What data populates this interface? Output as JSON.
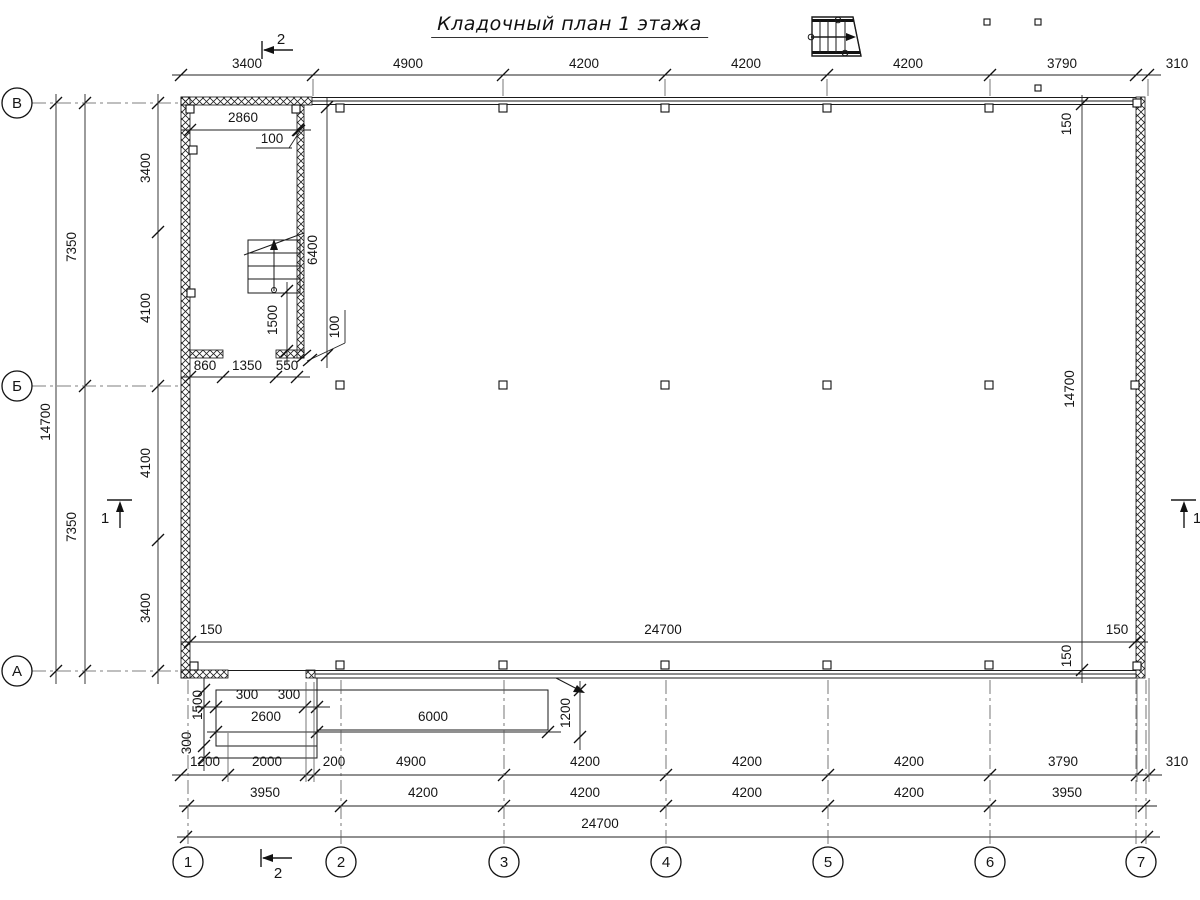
{
  "title": "Кладочный план 1 этажа",
  "axes": {
    "rows": [
      {
        "label": "В",
        "cy": 103
      },
      {
        "label": "Б",
        "cy": 386
      },
      {
        "label": "А",
        "cy": 671
      }
    ],
    "cols": [
      {
        "label": "1",
        "cx": 188
      },
      {
        "label": "2",
        "cx": 341
      },
      {
        "label": "3",
        "cx": 504
      },
      {
        "label": "4",
        "cx": 666
      },
      {
        "label": "5",
        "cx": 828
      },
      {
        "label": "6",
        "cx": 990
      },
      {
        "label": "7",
        "cx": 1141
      }
    ]
  },
  "sections": [
    {
      "label": "2",
      "x": 281,
      "y": 44,
      "pos": "top"
    },
    {
      "label": "2",
      "x": 278,
      "y": 878,
      "pos": "bottom"
    },
    {
      "label": "1",
      "x": 105,
      "y": 523,
      "pos": "left"
    },
    {
      "label": "1",
      "x": 1197,
      "y": 523,
      "pos": "right"
    }
  ],
  "dim_labels": [
    {
      "t": "3400",
      "x": 247,
      "y": 68
    },
    {
      "t": "4900",
      "x": 408,
      "y": 68
    },
    {
      "t": "4200",
      "x": 584,
      "y": 68
    },
    {
      "t": "4200",
      "x": 746,
      "y": 68
    },
    {
      "t": "4200",
      "x": 908,
      "y": 68
    },
    {
      "t": "3790",
      "x": 1062,
      "y": 68
    },
    {
      "t": "310",
      "x": 1177,
      "y": 68
    },
    {
      "t": "2860",
      "x": 243,
      "y": 122
    },
    {
      "t": "100",
      "x": 272,
      "y": 143
    },
    {
      "t": "6400",
      "x": 317,
      "y": 250,
      "r": -90
    },
    {
      "t": "1500",
      "x": 277,
      "y": 320,
      "r": -90
    },
    {
      "t": "100",
      "x": 339,
      "y": 327,
      "r": -90
    },
    {
      "t": "860",
      "x": 205,
      "y": 370
    },
    {
      "t": "1350",
      "x": 247,
      "y": 370
    },
    {
      "t": "550",
      "x": 287,
      "y": 370
    },
    {
      "t": "3400",
      "x": 150,
      "y": 168,
      "r": -90
    },
    {
      "t": "4100",
      "x": 150,
      "y": 308,
      "r": -90
    },
    {
      "t": "4100",
      "x": 150,
      "y": 463,
      "r": -90
    },
    {
      "t": "3400",
      "x": 150,
      "y": 608,
      "r": -90
    },
    {
      "t": "7350",
      "x": 76,
      "y": 247,
      "r": -90
    },
    {
      "t": "7350",
      "x": 76,
      "y": 527,
      "r": -90
    },
    {
      "t": "14700",
      "x": 50,
      "y": 422,
      "r": -90
    },
    {
      "t": "150",
      "x": 1071,
      "y": 124,
      "r": -90
    },
    {
      "t": "14700",
      "x": 1074,
      "y": 389,
      "r": -90
    },
    {
      "t": "150",
      "x": 1071,
      "y": 656,
      "r": -90
    },
    {
      "t": "150",
      "x": 211,
      "y": 634
    },
    {
      "t": "24700",
      "x": 663,
      "y": 634
    },
    {
      "t": "150",
      "x": 1117,
      "y": 634
    },
    {
      "t": "300",
      "x": 247,
      "y": 699
    },
    {
      "t": "300",
      "x": 289,
      "y": 699
    },
    {
      "t": "2600",
      "x": 266,
      "y": 721
    },
    {
      "t": "6000",
      "x": 433,
      "y": 721
    },
    {
      "t": "1200",
      "x": 570,
      "y": 713,
      "r": -90
    },
    {
      "t": "1500",
      "x": 202,
      "y": 705,
      "r": -90
    },
    {
      "t": "300",
      "x": 191,
      "y": 743,
      "r": -90
    },
    {
      "t": "1200",
      "x": 205,
      "y": 766
    },
    {
      "t": "2000",
      "x": 267,
      "y": 766
    },
    {
      "t": "200",
      "x": 334,
      "y": 766
    },
    {
      "t": "4900",
      "x": 411,
      "y": 766
    },
    {
      "t": "4200",
      "x": 585,
      "y": 766
    },
    {
      "t": "4200",
      "x": 747,
      "y": 766
    },
    {
      "t": "4200",
      "x": 909,
      "y": 766
    },
    {
      "t": "3790",
      "x": 1063,
      "y": 766
    },
    {
      "t": "310",
      "x": 1177,
      "y": 766
    },
    {
      "t": "3950",
      "x": 265,
      "y": 797
    },
    {
      "t": "4200",
      "x": 423,
      "y": 797
    },
    {
      "t": "4200",
      "x": 585,
      "y": 797
    },
    {
      "t": "4200",
      "x": 747,
      "y": 797
    },
    {
      "t": "4200",
      "x": 909,
      "y": 797
    },
    {
      "t": "3950",
      "x": 1067,
      "y": 797
    },
    {
      "t": "24700",
      "x": 600,
      "y": 828
    }
  ]
}
